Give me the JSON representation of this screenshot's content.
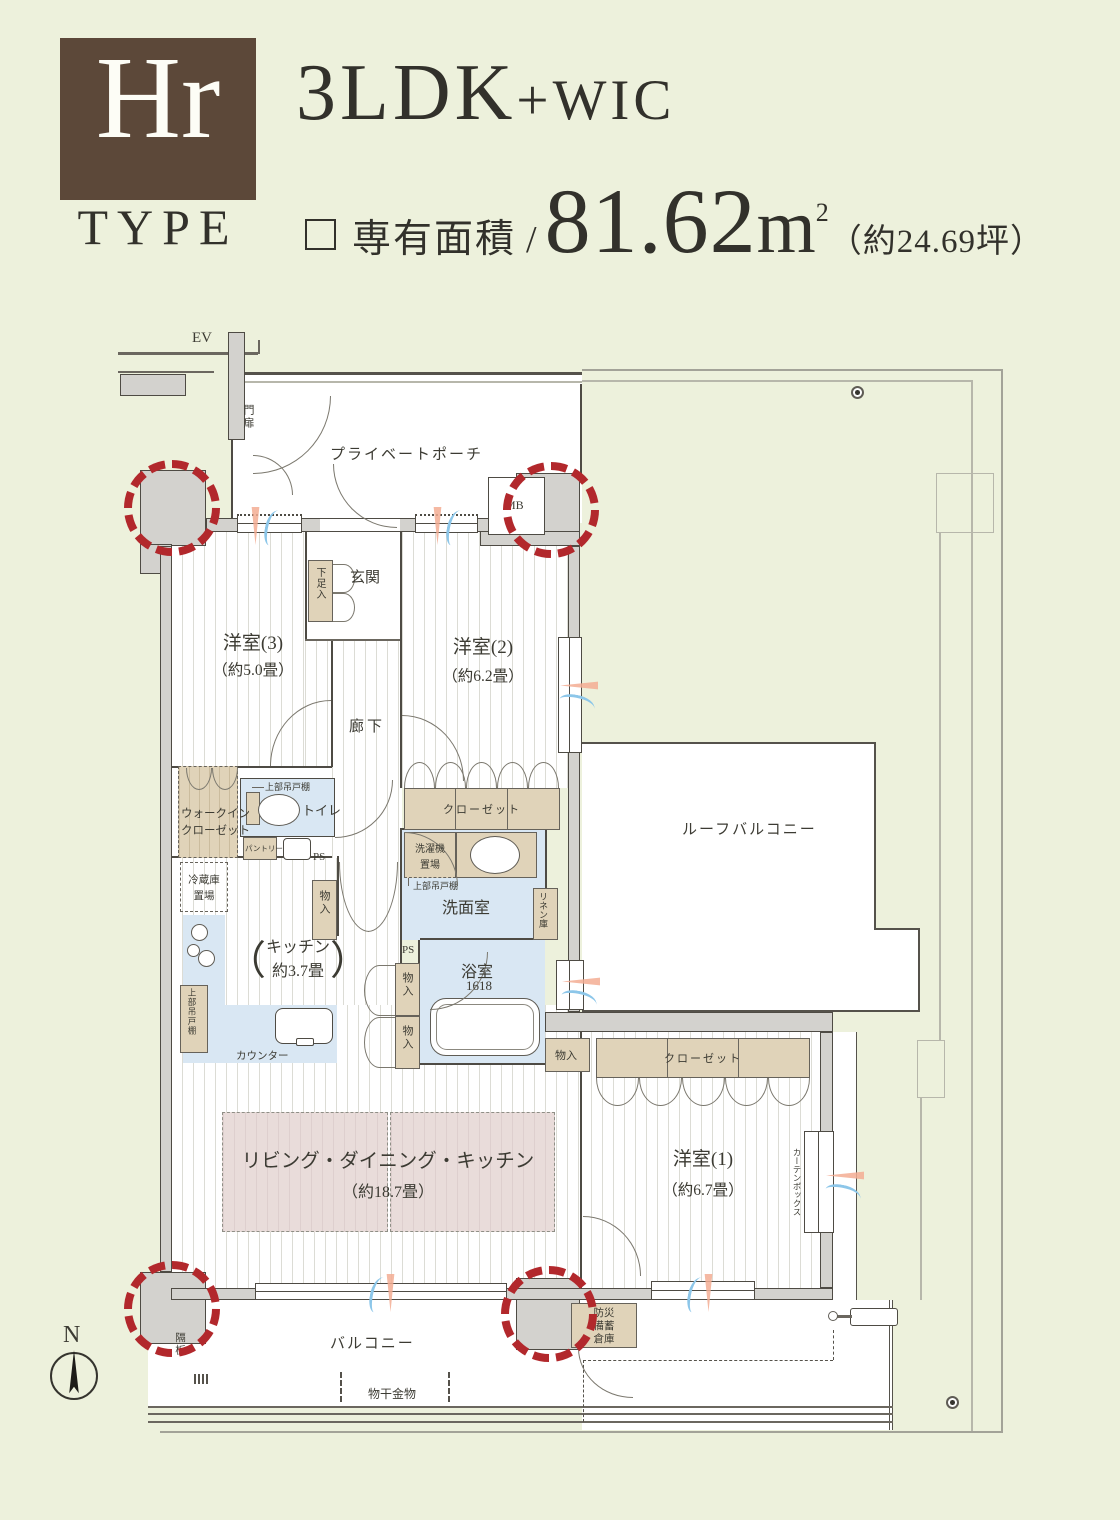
{
  "header": {
    "type_code": "Hr",
    "type_label": "TYPE",
    "layout": "3LDK",
    "layout_plus": "+WIC",
    "area_label": "専有面積",
    "area_slash": "/",
    "area_value": "81.62",
    "area_unit": "m",
    "area_sup": "2",
    "area_tsubo": "（約24.69坪）"
  },
  "labels": {
    "ev": "EV",
    "gate": "門扉",
    "private_porch": "プライベートポーチ",
    "mb": "MB",
    "genkan": "玄関",
    "shoe_box": "下足入",
    "room3": "洋室(3)",
    "room3_size": "（約5.0畳）",
    "room2": "洋室(2)",
    "room2_size": "（約6.2畳）",
    "corridor": "廊下",
    "wic_line1": "ウォークイン",
    "wic_line2": "クローゼット",
    "upper_cabinet": "上部吊戸棚",
    "toilet": "トイレ",
    "pantry": "パントリー",
    "ps": "PS",
    "fridge_line1": "冷蔵庫",
    "fridge_line2": "置場",
    "storage": "物入",
    "washer_line1": "洗濯機",
    "washer_line2": "置場",
    "washroom": "洗面室",
    "linen": "リネン庫",
    "paren_open": "（",
    "paren_close": "）",
    "kitchen": "キッチン",
    "kitchen_size": "約3.7畳",
    "counter": "カウンター",
    "bath": "浴室",
    "bath_size": "1618",
    "closet": "クローゼット",
    "ldk": "リビング・ダイニング・キッチン",
    "ldk_size": "（約18.7畳）",
    "room1": "洋室(1)",
    "room1_size": "（約6.7畳）",
    "curtain_box": "カーテンボックス",
    "roof_balcony": "ルーフバルコニー",
    "balcony": "バルコニー",
    "disaster_line1": "防災",
    "disaster_line2": "備蓄",
    "disaster_line3": "倉庫",
    "partition_board": "隔板",
    "laundry_hanger": "物干金物",
    "north": "N"
  },
  "colors": {
    "background": "#edf1dc",
    "type_box_brown": "#5c4839",
    "accent_red": "#b2282c",
    "closet_tan": "#e0d3b9",
    "wet_area_blue": "#d9e7f3",
    "ldk_pink": "#e9dcda",
    "wall_gray": "#d3d2ce"
  }
}
